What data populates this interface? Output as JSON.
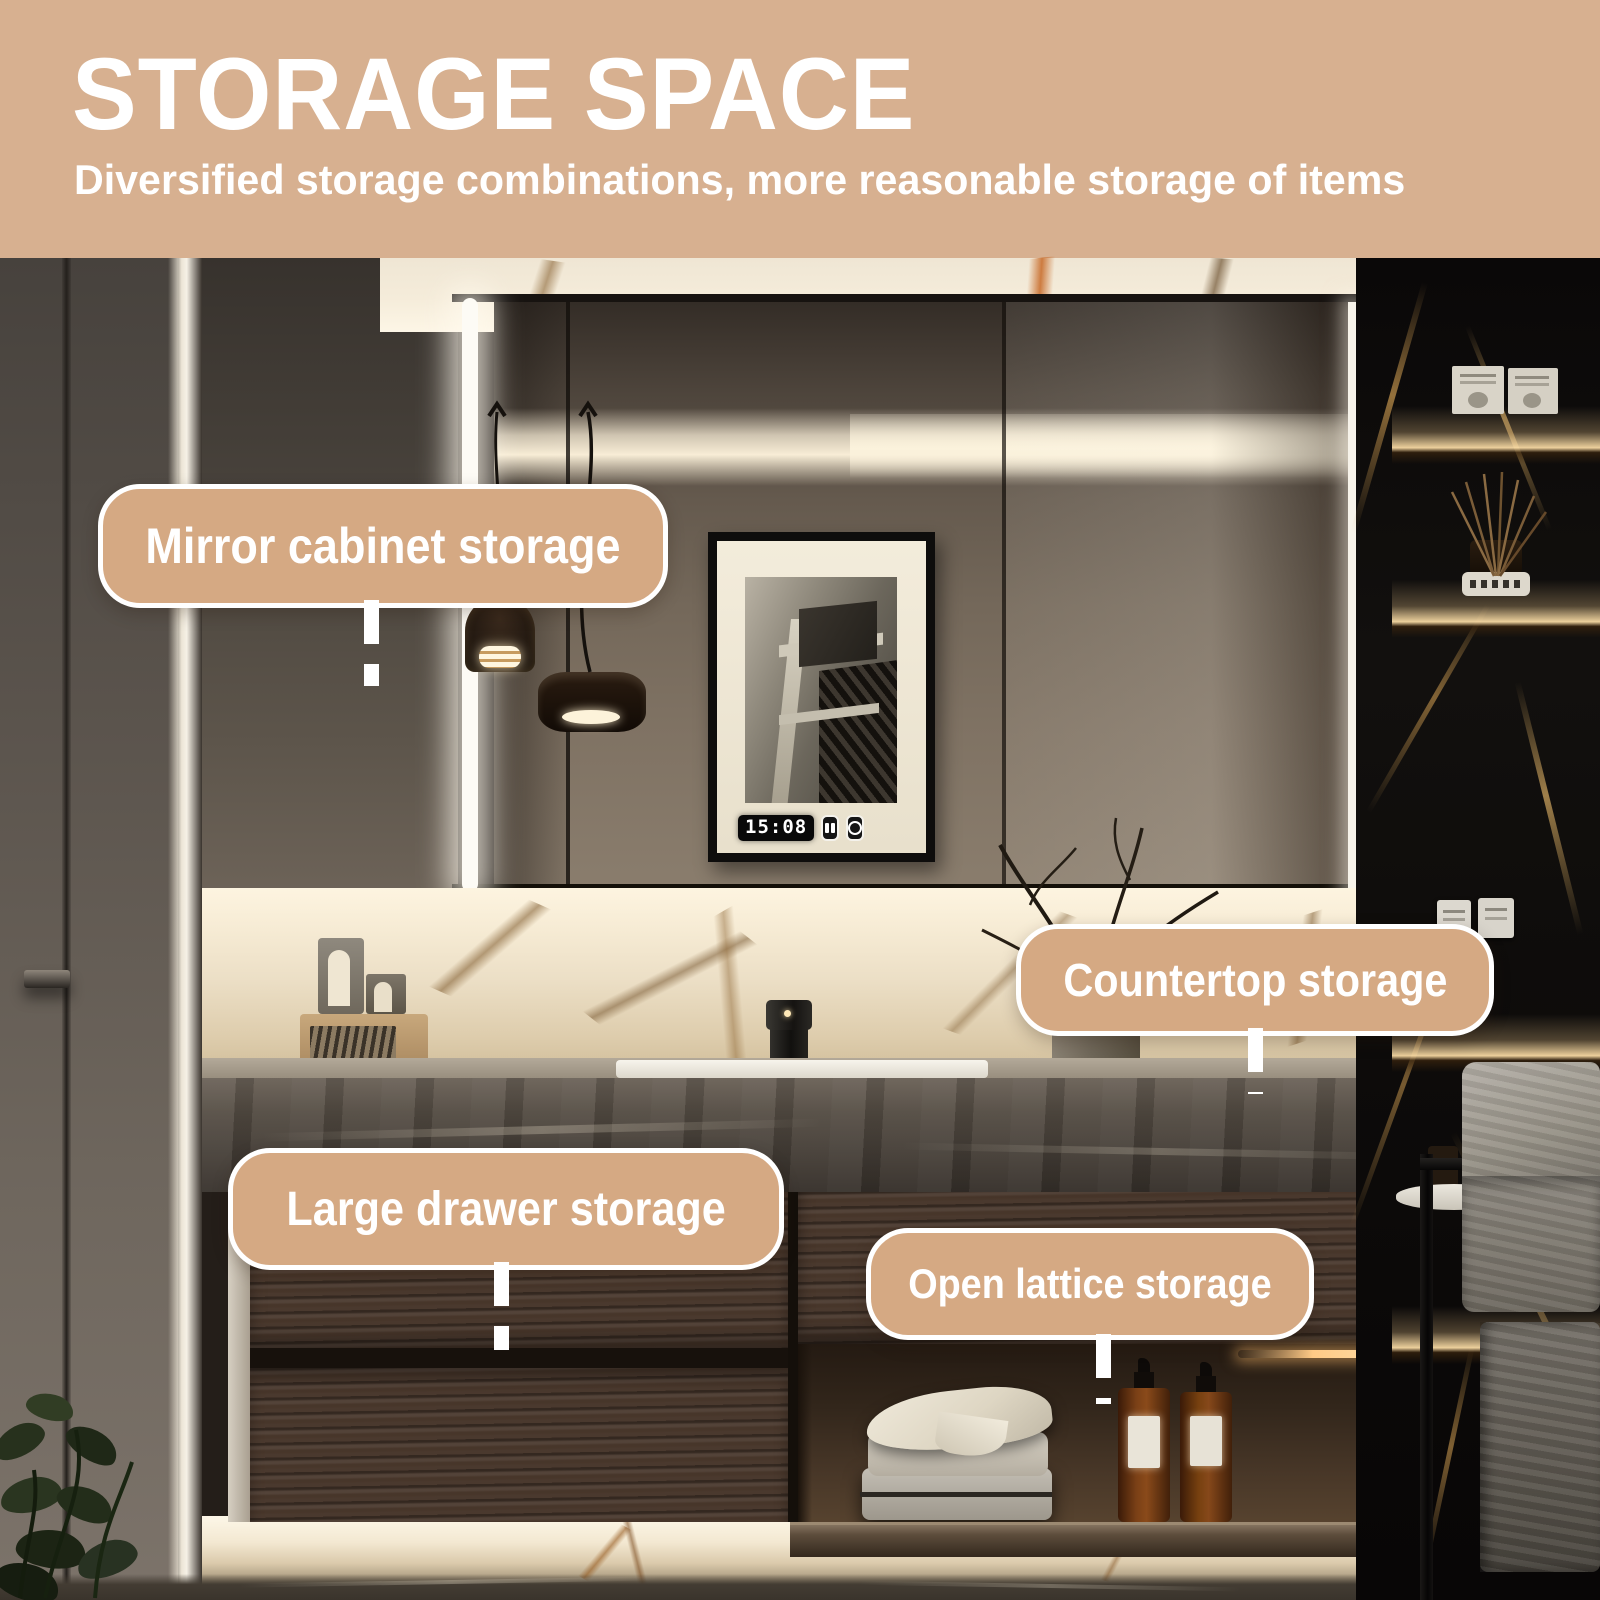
{
  "header": {
    "title": "STORAGE SPACE",
    "subtitle": "Diversified storage combinations, more reasonable storage of items",
    "background": "#d7b090",
    "text_color": "#ffffff"
  },
  "callouts": [
    {
      "id": "mirror",
      "label": "Mirror cabinet storage"
    },
    {
      "id": "countertop",
      "label": "Countertop storage"
    },
    {
      "id": "drawer",
      "label": "Large drawer storage"
    },
    {
      "id": "lattice",
      "label": "Open lattice storage"
    }
  ],
  "callout_style": {
    "background": "#d5a983",
    "border": "#ffffff",
    "text": "#ffffff"
  },
  "mirror_display": {
    "time": "15:08",
    "icons": [
      "screen-icon",
      "defog-icon"
    ]
  },
  "palette": {
    "header_tan": "#d7b090",
    "pill_tan": "#d5a983",
    "led_warm_white": "#f8edd6",
    "marble_cream": "#efe5d2",
    "vein_gold": "#8a6a3f",
    "wood_brown": "#4a392e",
    "counter_stone": "#4b453d",
    "black_marble": "#0d0b0a",
    "amber_bottle": "#6e3a14",
    "towel_gray": "#9a958e"
  }
}
